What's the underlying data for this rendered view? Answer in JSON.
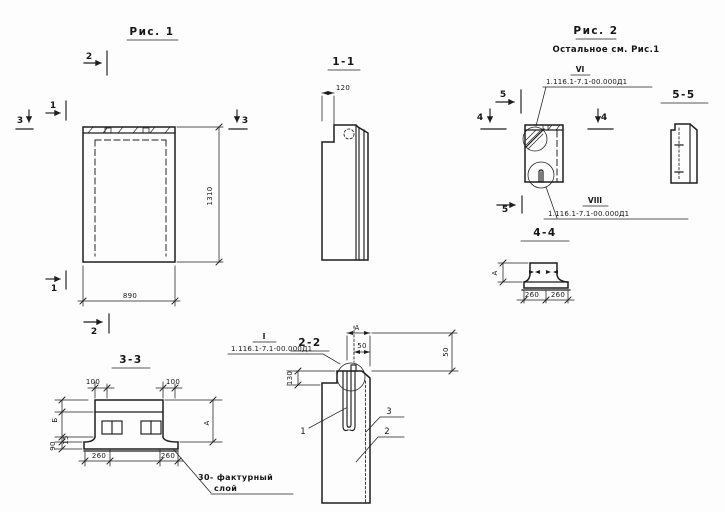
{
  "meta": {
    "paper": "#fdfdfd",
    "ink": "#1e1e1e"
  },
  "fig1": {
    "title": "Рис. 1",
    "dim_width": "890",
    "dim_height": "1310",
    "markers": {
      "top": "2",
      "left_upper": "1",
      "left_lower": "3",
      "right": "3",
      "bottom_left": "1",
      "bottom": "2"
    }
  },
  "fig2": {
    "title": "Рис. 2",
    "subtitle": "Остальное см. Рис.1",
    "markers": {
      "top": "5",
      "left": "4",
      "right": "4",
      "bottom": "5"
    },
    "callout_vi": {
      "num": "VI",
      "doc": "1.116.1-7.1-00.000Д1"
    },
    "callout_viii": {
      "num": "VIII",
      "doc": "1.116.1-7.1-00.000Д1"
    }
  },
  "s11": {
    "title": "1-1",
    "dim_top": "120"
  },
  "s22": {
    "title": "2-2",
    "callout": {
      "num": "I",
      "doc": "1.116.1-7.1-00.000Д1"
    },
    "dim_a": "А",
    "dim_50_top": "50",
    "dim_50_right": "50",
    "dim_130": "130",
    "part_1": "1",
    "part_2": "2",
    "part_3": "3"
  },
  "s33": {
    "title": "3-3",
    "dim_100_left": "100",
    "dim_100_right": "100",
    "dim_260_left": "260",
    "dim_260_right": "260",
    "dim_b": "Б",
    "dim_15": "15",
    "dim_90": "90",
    "dim_a": "А",
    "note_line1": "30- фактурный",
    "note_line2": "слой"
  },
  "s44": {
    "title": "4-4",
    "dim_260_left": "260",
    "dim_260_right": "260",
    "dim_a": "А"
  },
  "s55": {
    "title": "5-5"
  }
}
